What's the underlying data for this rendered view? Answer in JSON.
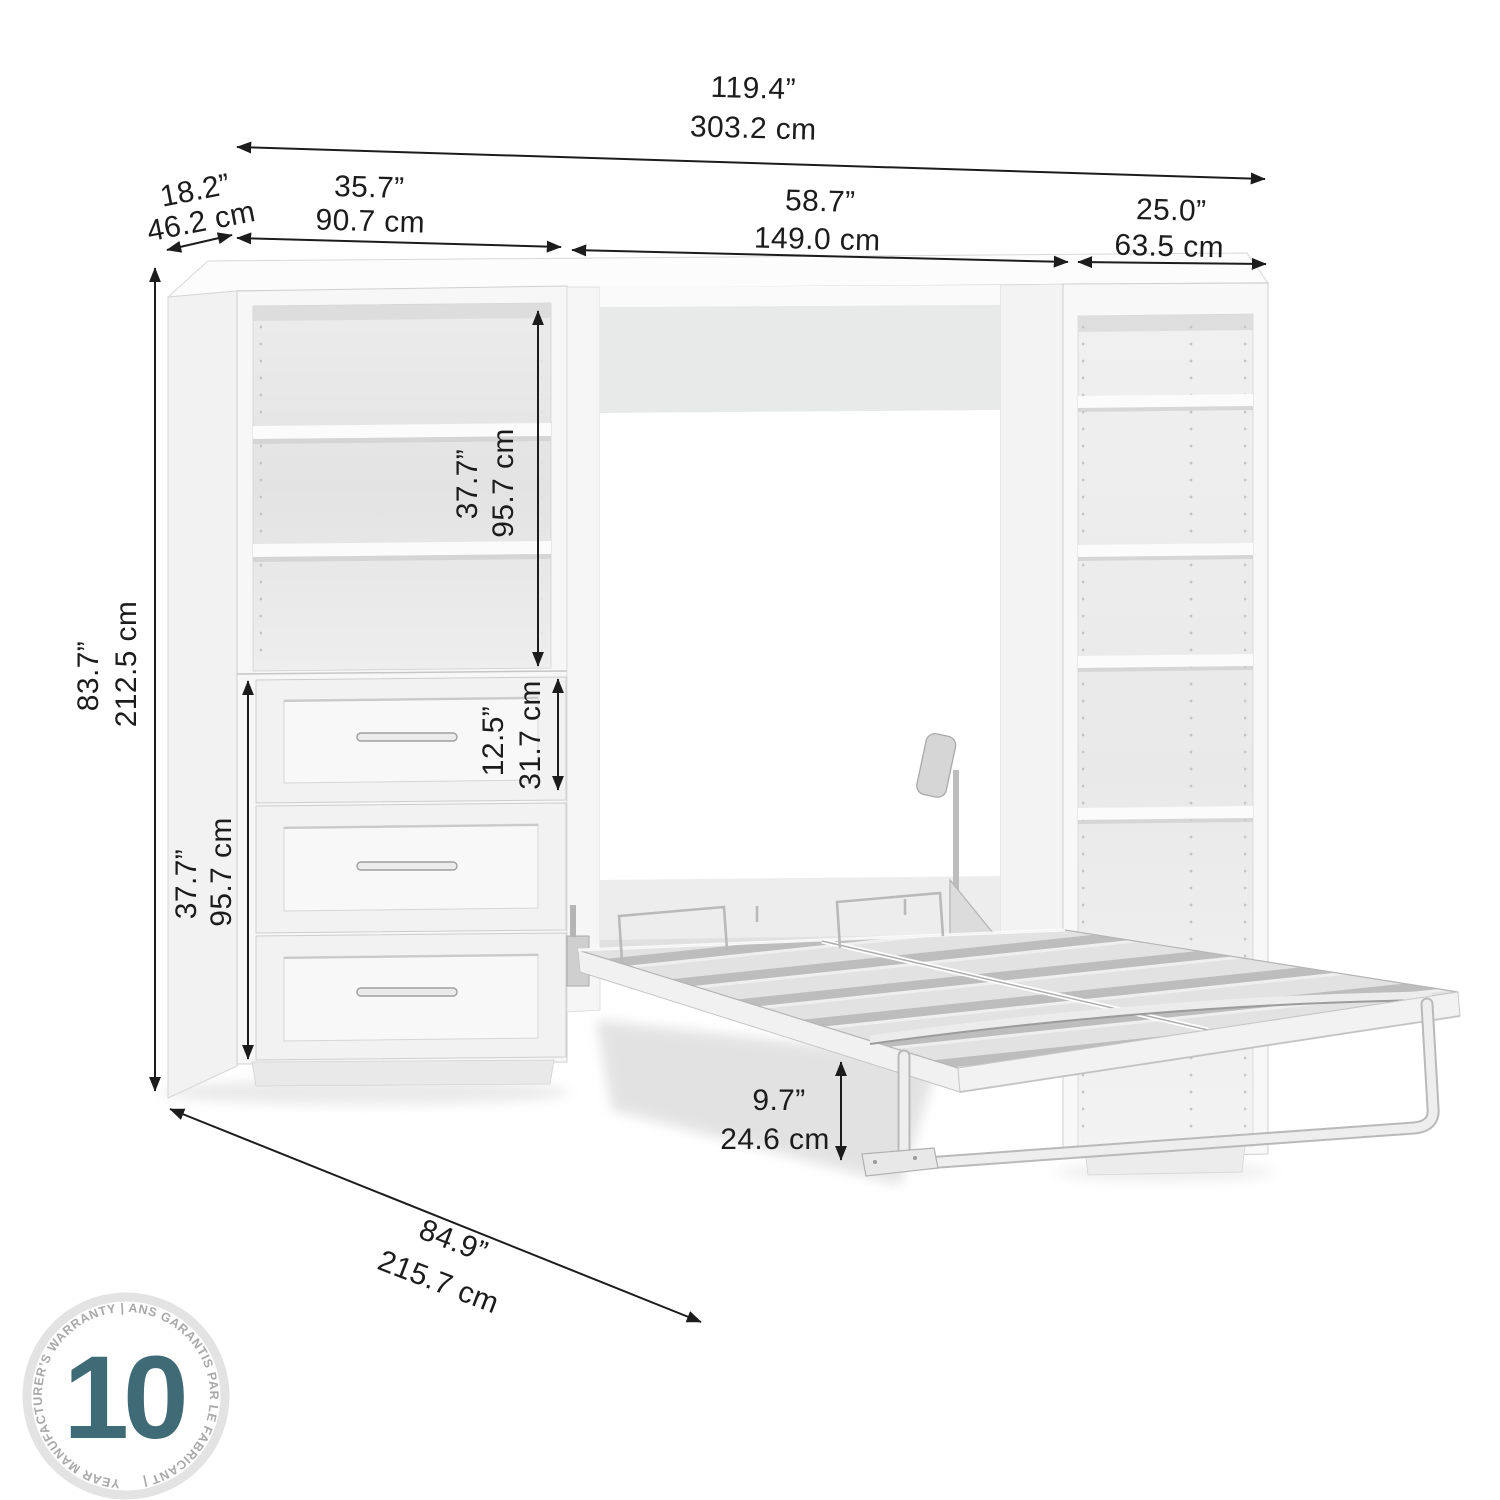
{
  "dimensions": {
    "overall_width": {
      "inches": "119.4”",
      "cm": "303.2 cm"
    },
    "depth": {
      "inches": "18.2”",
      "cm": "46.2 cm"
    },
    "left_storage_width": {
      "inches": "35.7”",
      "cm": "90.7 cm"
    },
    "bed_cabinet_width": {
      "inches": "58.7”",
      "cm": "149.0 cm"
    },
    "right_storage_width": {
      "inches": "25.0”",
      "cm": "63.5 cm"
    },
    "overall_height": {
      "inches": "83.7”",
      "cm": "212.5 cm"
    },
    "shelf_section_height": {
      "inches": "37.7”",
      "cm": "95.7 cm"
    },
    "drawer_front_height": {
      "inches": "12.5”",
      "cm": "31.7 cm"
    },
    "drawer_section_height": {
      "inches": "37.7”",
      "cm": "95.7 cm"
    },
    "bed_floor_clearance": {
      "inches": "9.7”",
      "cm": "24.6 cm"
    },
    "open_bed_depth": {
      "inches": "84.9”",
      "cm": "215.7 cm"
    }
  },
  "badge": {
    "number": "10",
    "ring_text": "YEAR MANUFACTURER’S WARRANTY  |  ANS GARANTIS PAR LE FABRICANT  |"
  },
  "colors": {
    "dimension_ink": "#1c1c1c",
    "badge_number": "#3f6b77",
    "badge_ring": "#e3e3e3",
    "badge_text": "#a8a8a8"
  }
}
